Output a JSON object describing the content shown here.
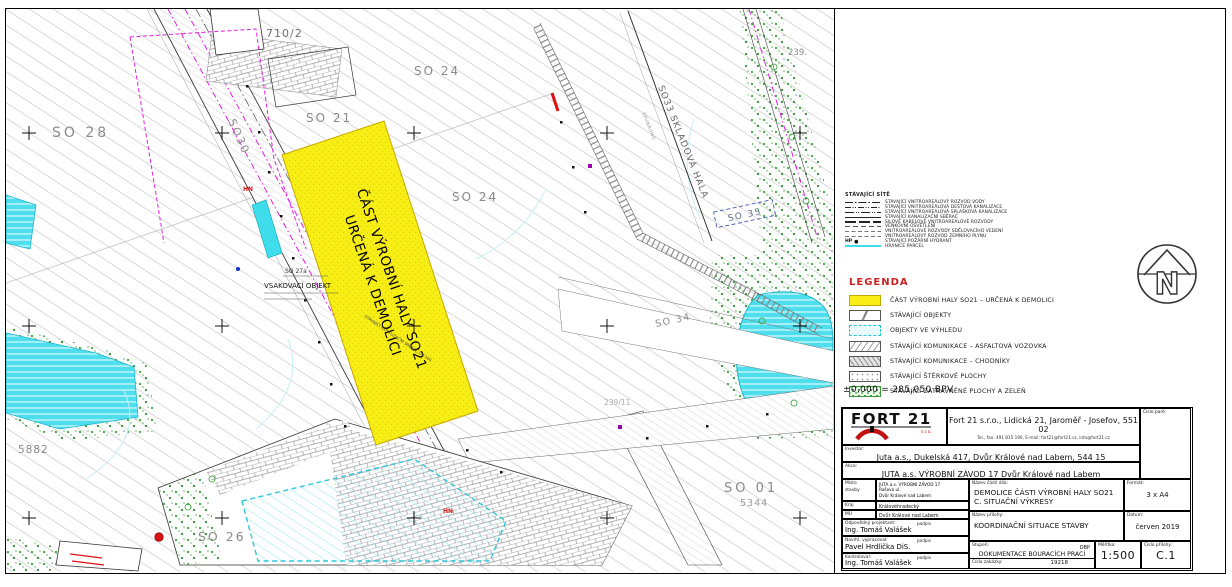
{
  "map": {
    "hall": {
      "line1": "ČÁST VÝROBNÍ HALY SO21",
      "line2": "URČENÁ K DEMOLICI",
      "note": "STÁVAJÍCÍ KANALIZAČNÍ SBĚRAČ DN 300"
    },
    "labels": {
      "so28": "SO 28",
      "so30": "SO30",
      "so21": "SO 21",
      "parcel710": "710/2",
      "so24a": "SO 24",
      "so24b": "SO 24",
      "so33": "SO33  SKLADOVÁ HALA",
      "spunbond": "SPUNBOND",
      "so35": "SO 35",
      "n239": "239.",
      "so34": "SO 34",
      "so01": "SO 01",
      "parcel5344": "5344",
      "parcel5882": "5882",
      "so26": "SO 26",
      "parcel239_11": "239/11",
      "so27a": "SO 27a",
      "vsak": "VSAKOVACÍ OBJEKT",
      "hn": "HN"
    }
  },
  "networks": {
    "title": "STÁVAJÍCÍ SÍTĚ",
    "hp_prefix": "HP",
    "items": [
      {
        "label": "STÁVAJÍCÍ VNITROAREÁLOVÝ ROZVOD VODY"
      },
      {
        "label": "STÁVAJÍCÍ VNITROAREÁLOVÁ DEŠŤOVÁ KANALIZACE"
      },
      {
        "label": "STÁVAJÍCÍ VNITROAREÁLOVÁ SPLAŠKOVÁ KANALIZACE"
      },
      {
        "label": "STÁVAJÍCÍ KANALIZAČNÍ SBĚRAČ"
      },
      {
        "label": "SILOVÉ KABELOVÉ VNITROAREÁLOVÉ ROZVODY"
      },
      {
        "label": "VENKOVNÍ OSVĚTLENÍ"
      },
      {
        "label": "VNITROAREÁLOVÉ ROZVODY SDĚLOVACÍHO VEDENÍ"
      },
      {
        "label": "VNITROAREÁLOVÝ ROZVOD ZEMNÍHO PLYNU"
      },
      {
        "label": "STÁVAJÍCÍ POŽÁRNÍ HYDRANT"
      },
      {
        "label": "HRANICE PARCEL"
      }
    ]
  },
  "legend": {
    "title": "LEGENDA",
    "items": [
      {
        "label": "ČÁST VÝROBNÍ HALY SO21 – URČENÁ K DEMOLICI"
      },
      {
        "label": "STÁVAJÍCÍ OBJEKTY"
      },
      {
        "label": "OBJEKTY VE VÝHLEDU"
      },
      {
        "label": "STÁVAJÍCÍ KOMUNIKACE – ASFALTOVÁ VOZOVKA"
      },
      {
        "label": "STÁVAJÍCÍ KOMUNIKACE – CHODNÍKY"
      },
      {
        "label": "STÁVAJÍCÍ ŠTĚRKOVÉ PLOCHY"
      },
      {
        "label": "STÁVAJÍCÍ ZATRAVNĚNÉ PLOCHY A ZELEŇ"
      }
    ]
  },
  "elevation_note": "±0,000 = 285,050 BPV",
  "north": {
    "letter": "N"
  },
  "titleblock": {
    "pare_label": "Číslo paré:",
    "logo": {
      "text": "FORT 21",
      "sub": "s.r.o."
    },
    "company_line1": "Fort 21 s.r.o., Lidická 21, Jaroměř - Josefov, 551 02",
    "company_line2": "Tel., fax: 491 815 190, E-mail: fort21@fort21.cz, info@fort21.cz",
    "investor_label": "Investor:",
    "investor": "Juta a.s., Dukelská 417, Dvůr Králové nad Labem, 544 15",
    "akce_label": "Akce:",
    "akce": "JUTA a.s. VÝROBNÍ ZÁVOD 17 Dvůr Králové nad Labem",
    "misto_label1": "Místo",
    "misto_label2": "stavby",
    "misto_l1": "JUTA a.s. VÝROBNÍ ZÁVOD 17",
    "misto_l2": "Rašova ul.",
    "misto_l3": "Dvůr Králové nad Labem",
    "kraj_label": "Kraj",
    "kraj": "Královéhradecký",
    "mu_label": "MÚ",
    "mu": "Dvůr Králové nad Labem",
    "podpis": "podpis",
    "resp_label": "Odpovědný projektant:",
    "resp": "Ing. Tomáš Valášek",
    "made_label": "Navrhl, vypracoval:",
    "made": "Pavel Hrdlička DiS.",
    "check_label": "Kontroloval:",
    "check": "Ing. Tomáš Valášek",
    "part_label": "Název části díla:",
    "part_l1": "DEMOLICE ČÁSTI VÝROBNÍ HALY SO21",
    "part_l2": "C. SITUAČNÍ VÝKRESY",
    "format_label": "Formát:",
    "format": "3 x A4",
    "drawing_label": "Název přílohy:",
    "drawing": "KOORDINAČNÍ SITUACE STAVBY",
    "date_label": "Datum:",
    "date": "červen 2019",
    "stage_label": "Stupeň:",
    "stage": "DOKUMENTACE BOURACÍCH PRACÍ",
    "stage_code": "DBP",
    "order_label": "Číslo zakázky:",
    "order": "19218",
    "scale_label": "Měřítko:",
    "scale": "1:500",
    "sheet_label": "Číslo přílohy:",
    "sheet": "C.1"
  }
}
